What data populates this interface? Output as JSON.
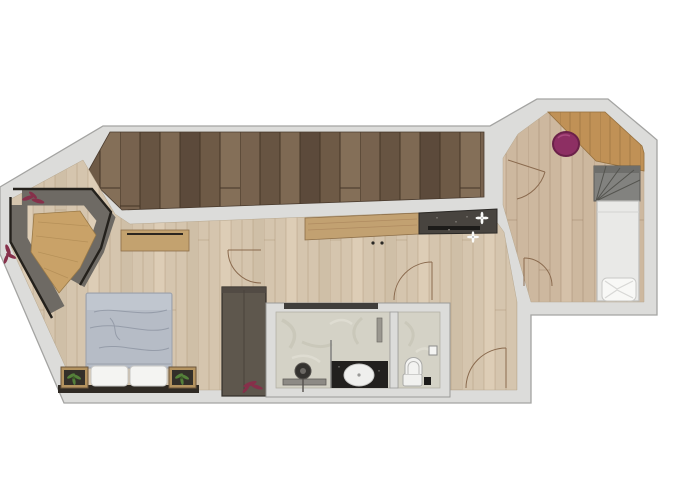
{
  "scene": {
    "kind": "apartment-floor-plan-rendering",
    "background": "#ffffff"
  },
  "colors": {
    "wall": "#dcdcda",
    "wallStroke": "#a4a4a2",
    "innerLine": "#8f8f8d",
    "deckBase": "#6f5a47",
    "floorBase": "#d5c5ae",
    "hallFloorBase": "#cdb89f",
    "slopeWood": "#c09156",
    "bench": "#6e6a64",
    "benchEdge": "#24211c",
    "nookTable": "#c9a268",
    "sideboardWood": "#c2a171",
    "dresserWood": "#c3a26f",
    "counterDark": "#48443f",
    "counterGroove": "#1c1b19",
    "bedDuvet": "#b6bcc6",
    "bedFold": "#8e95a2",
    "pillowWhite": "#f4f4f2",
    "bedRug": "#2f2a24",
    "nightstandWood": "#b4935f",
    "nightstandInner": "#332f29",
    "plantGreen": "#55803a",
    "wardrobe": "#5e574d",
    "plantBurgundy": "#86304a",
    "marble": "#d4d2c6",
    "showerDark": "#22201e",
    "basinWhite": "#efefed",
    "toiletWhite": "#f1f1ef",
    "fixtureStroke": "#a9a9a7",
    "mirrorDark": "#34322f",
    "vanityBar": "#8d8a85",
    "glassLine": "#7a7a78",
    "stairGray": "#82827f",
    "stairLine": "#54544f",
    "singleBed": "#e9e9e7",
    "singleBedStroke": "#bdbdbb",
    "pouf": "#8d2f63",
    "poufStroke": "#6b2149",
    "doorArc": "#8a6a4e",
    "glassStripe": "#403e3b"
  },
  "legend": {
    "areas": [
      {
        "id": "terrace-deck"
      },
      {
        "id": "dining-nook"
      },
      {
        "id": "bedroom"
      },
      {
        "id": "living-area"
      },
      {
        "id": "bathroom"
      },
      {
        "id": "wc"
      },
      {
        "id": "hall"
      },
      {
        "id": "stair-room"
      }
    ],
    "objects": [
      {
        "id": "dining-bench"
      },
      {
        "id": "dining-table"
      },
      {
        "id": "double-bed"
      },
      {
        "id": "bed-pillows",
        "count": 2
      },
      {
        "id": "nightstands",
        "count": 2
      },
      {
        "id": "potted-plants-green",
        "count": 2
      },
      {
        "id": "wardrobe"
      },
      {
        "id": "dresser"
      },
      {
        "id": "kitchen-sideboard"
      },
      {
        "id": "kitchen-counter-dark"
      },
      {
        "id": "decor-flowers-white",
        "count": 2
      },
      {
        "id": "vanity-mirror"
      },
      {
        "id": "vanity-bench"
      },
      {
        "id": "shower-area"
      },
      {
        "id": "oval-basin"
      },
      {
        "id": "toilet"
      },
      {
        "id": "waste-bin"
      },
      {
        "id": "staircase-winder"
      },
      {
        "id": "single-bed"
      },
      {
        "id": "single-bed-pillow"
      },
      {
        "id": "pouf-magenta"
      },
      {
        "id": "roof-slope-band"
      },
      {
        "id": "door-arcs",
        "count": 5
      },
      {
        "id": "burgundy-plants",
        "count": 3
      }
    ]
  }
}
